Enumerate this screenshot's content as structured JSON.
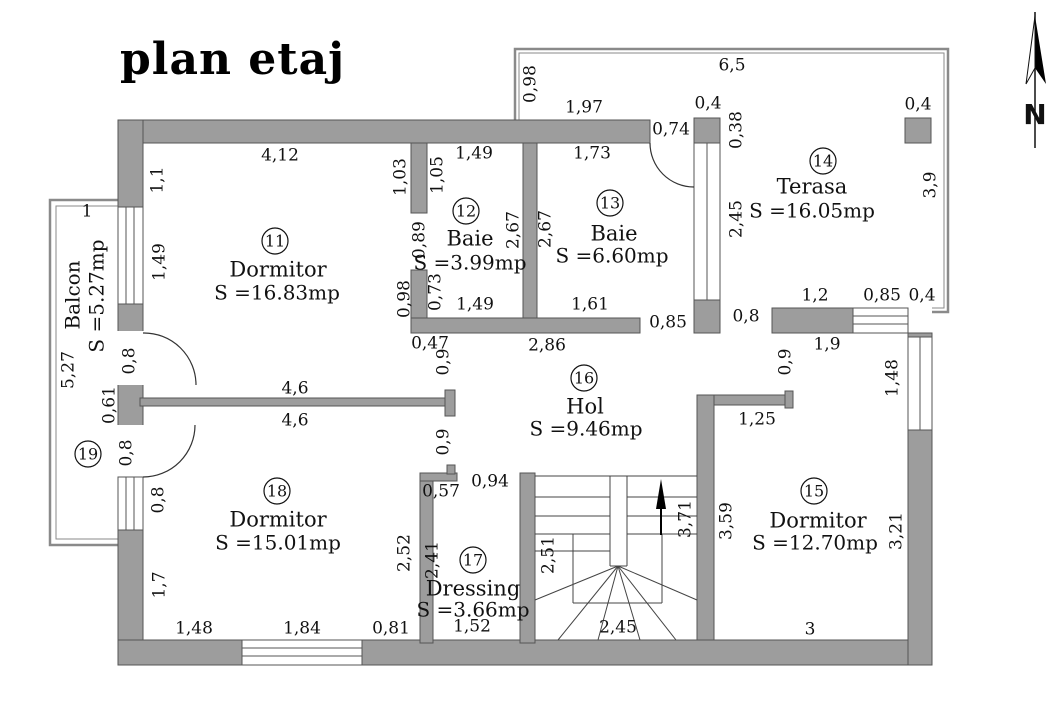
{
  "title": "plan etaj",
  "north_label": "N",
  "colors": {
    "wall": "#9d9d9d",
    "wall_edge": "#555555",
    "line": "#333333",
    "outline": "#8a8a8a",
    "text": "#111111"
  },
  "rooms": [
    {
      "number": "11",
      "name": "Dormitor",
      "area": "S =16.83mp",
      "circle": {
        "x": 275,
        "y": 241
      },
      "name_pos": {
        "x": 278,
        "y": 271
      },
      "area_pos": {
        "x": 277,
        "y": 294
      }
    },
    {
      "number": "12",
      "name": "Baie",
      "area": "S =3.99mp",
      "circle": {
        "x": 466,
        "y": 211
      },
      "name_pos": {
        "x": 470,
        "y": 240
      },
      "area_pos": {
        "x": 470,
        "y": 264
      }
    },
    {
      "number": "13",
      "name": "Baie",
      "area": "S =6.60mp",
      "circle": {
        "x": 610,
        "y": 203
      },
      "name_pos": {
        "x": 614,
        "y": 235
      },
      "area_pos": {
        "x": 612,
        "y": 257
      }
    },
    {
      "number": "14",
      "name": "Terasa",
      "area": "S =16.05mp",
      "circle": {
        "x": 823,
        "y": 161
      },
      "name_pos": {
        "x": 812,
        "y": 188
      },
      "area_pos": {
        "x": 812,
        "y": 212
      }
    },
    {
      "number": "15",
      "name": "Dormitor",
      "area": "S =12.70mp",
      "circle": {
        "x": 814,
        "y": 491
      },
      "name_pos": {
        "x": 818,
        "y": 522
      },
      "area_pos": {
        "x": 815,
        "y": 544
      }
    },
    {
      "number": "16",
      "name": "Hol",
      "area": "S =9.46mp",
      "circle": {
        "x": 584,
        "y": 378
      },
      "name_pos": {
        "x": 585,
        "y": 408
      },
      "area_pos": {
        "x": 586,
        "y": 430
      }
    },
    {
      "number": "17",
      "name": "Dressing",
      "area": "S =3.66mp",
      "circle": {
        "x": 473,
        "y": 560
      },
      "name_pos": {
        "x": 473,
        "y": 590
      },
      "area_pos": {
        "x": 473,
        "y": 611
      }
    },
    {
      "number": "18",
      "name": "Dormitor",
      "area": "S =15.01mp",
      "circle": {
        "x": 277,
        "y": 491
      },
      "name_pos": {
        "x": 278,
        "y": 521
      },
      "area_pos": {
        "x": 278,
        "y": 544
      }
    },
    {
      "number": "19",
      "name": "",
      "area": "",
      "circle": {
        "x": 88,
        "y": 454
      },
      "name_pos": {
        "x": 0,
        "y": 0
      },
      "area_pos": {
        "x": 0,
        "y": 0
      }
    }
  ],
  "balcony": {
    "name": "Balcon",
    "area": "S =5.27mp",
    "name_pos": {
      "x": 74,
      "y": 295
    },
    "area_pos": {
      "x": 98,
      "y": 296
    }
  },
  "dimensions": [
    {
      "t": "6,5",
      "x": 732,
      "y": 66,
      "r": 0
    },
    {
      "t": "0,98",
      "x": 531,
      "y": 84,
      "r": -90
    },
    {
      "t": "1,97",
      "x": 584,
      "y": 108,
      "r": 0
    },
    {
      "t": "0,4",
      "x": 708,
      "y": 104,
      "r": 0
    },
    {
      "t": "0,74",
      "x": 671,
      "y": 130,
      "r": 0
    },
    {
      "t": "0,38",
      "x": 737,
      "y": 130,
      "r": -90
    },
    {
      "t": "0,4",
      "x": 918,
      "y": 105,
      "r": 0
    },
    {
      "t": "3,9",
      "x": 931,
      "y": 185,
      "r": -90
    },
    {
      "t": "4,12",
      "x": 280,
      "y": 156,
      "r": 0
    },
    {
      "t": "1,1",
      "x": 158,
      "y": 180,
      "r": -90
    },
    {
      "t": "1,03",
      "x": 401,
      "y": 177,
      "r": -90
    },
    {
      "t": "1,05",
      "x": 438,
      "y": 175,
      "r": -90
    },
    {
      "t": "1,49",
      "x": 474,
      "y": 154,
      "r": 0
    },
    {
      "t": "1,73",
      "x": 592,
      "y": 154,
      "r": 0
    },
    {
      "t": "2,45",
      "x": 737,
      "y": 219,
      "r": -90
    },
    {
      "t": "1,49",
      "x": 160,
      "y": 262,
      "r": -90
    },
    {
      "t": "0,89",
      "x": 420,
      "y": 240,
      "r": -90
    },
    {
      "t": "2,67",
      "x": 514,
      "y": 230,
      "r": -90
    },
    {
      "t": "2,67",
      "x": 546,
      "y": 229,
      "r": -90
    },
    {
      "t": "0,73",
      "x": 436,
      "y": 292,
      "r": -90
    },
    {
      "t": "0,98",
      "x": 405,
      "y": 299,
      "r": -90
    },
    {
      "t": "1,49",
      "x": 475,
      "y": 305,
      "r": 0
    },
    {
      "t": "1,61",
      "x": 590,
      "y": 305,
      "r": 0
    },
    {
      "t": "0,85",
      "x": 668,
      "y": 323,
      "r": 0
    },
    {
      "t": "0,8",
      "x": 746,
      "y": 317,
      "r": 0
    },
    {
      "t": "1,2",
      "x": 815,
      "y": 296,
      "r": 0
    },
    {
      "t": "0,85",
      "x": 882,
      "y": 296,
      "r": 0
    },
    {
      "t": "0,4",
      "x": 922,
      "y": 296,
      "r": 0
    },
    {
      "t": "1,9",
      "x": 827,
      "y": 345,
      "r": 0
    },
    {
      "t": "0,47",
      "x": 430,
      "y": 344,
      "r": 0
    },
    {
      "t": "2,86",
      "x": 547,
      "y": 346,
      "r": 0
    },
    {
      "t": "0,9",
      "x": 444,
      "y": 362,
      "r": -90
    },
    {
      "t": "0,9",
      "x": 444,
      "y": 442,
      "r": -90
    },
    {
      "t": "1,48",
      "x": 893,
      "y": 378,
      "r": -90
    },
    {
      "t": "0,8",
      "x": 130,
      "y": 361,
      "r": -90
    },
    {
      "t": "0,61",
      "x": 110,
      "y": 405,
      "r": -90
    },
    {
      "t": "5,27",
      "x": 69,
      "y": 370,
      "r": -90
    },
    {
      "t": "1",
      "x": 87,
      "y": 212,
      "r": 0
    },
    {
      "t": "4,6",
      "x": 295,
      "y": 389,
      "r": 0
    },
    {
      "t": "4,6",
      "x": 295,
      "y": 421,
      "r": 0
    },
    {
      "t": "0,8",
      "x": 127,
      "y": 453,
      "r": -90
    },
    {
      "t": "0,8",
      "x": 159,
      "y": 500,
      "r": -90
    },
    {
      "t": "0,9",
      "x": 786,
      "y": 362,
      "r": -90
    },
    {
      "t": "1,25",
      "x": 757,
      "y": 420,
      "r": 0
    },
    {
      "t": "1,7",
      "x": 160,
      "y": 585,
      "r": -90
    },
    {
      "t": "2,52",
      "x": 405,
      "y": 553,
      "r": -90
    },
    {
      "t": "2,41",
      "x": 433,
      "y": 560,
      "r": -90
    },
    {
      "t": "0,57",
      "x": 441,
      "y": 492,
      "r": 0
    },
    {
      "t": "0,94",
      "x": 490,
      "y": 482,
      "r": 0
    },
    {
      "t": "2,51",
      "x": 549,
      "y": 555,
      "r": -90
    },
    {
      "t": "3,71",
      "x": 686,
      "y": 519,
      "r": -90
    },
    {
      "t": "3,59",
      "x": 727,
      "y": 521,
      "r": -90
    },
    {
      "t": "3,21",
      "x": 897,
      "y": 531,
      "r": -90
    },
    {
      "t": "1,48",
      "x": 194,
      "y": 629,
      "r": 0
    },
    {
      "t": "1,84",
      "x": 302,
      "y": 629,
      "r": 0
    },
    {
      "t": "0,81",
      "x": 391,
      "y": 629,
      "r": 0
    },
    {
      "t": "1,52",
      "x": 472,
      "y": 627,
      "r": 0
    },
    {
      "t": "2,45",
      "x": 618,
      "y": 628,
      "r": 0
    },
    {
      "t": "3",
      "x": 810,
      "y": 630,
      "r": 0
    }
  ]
}
